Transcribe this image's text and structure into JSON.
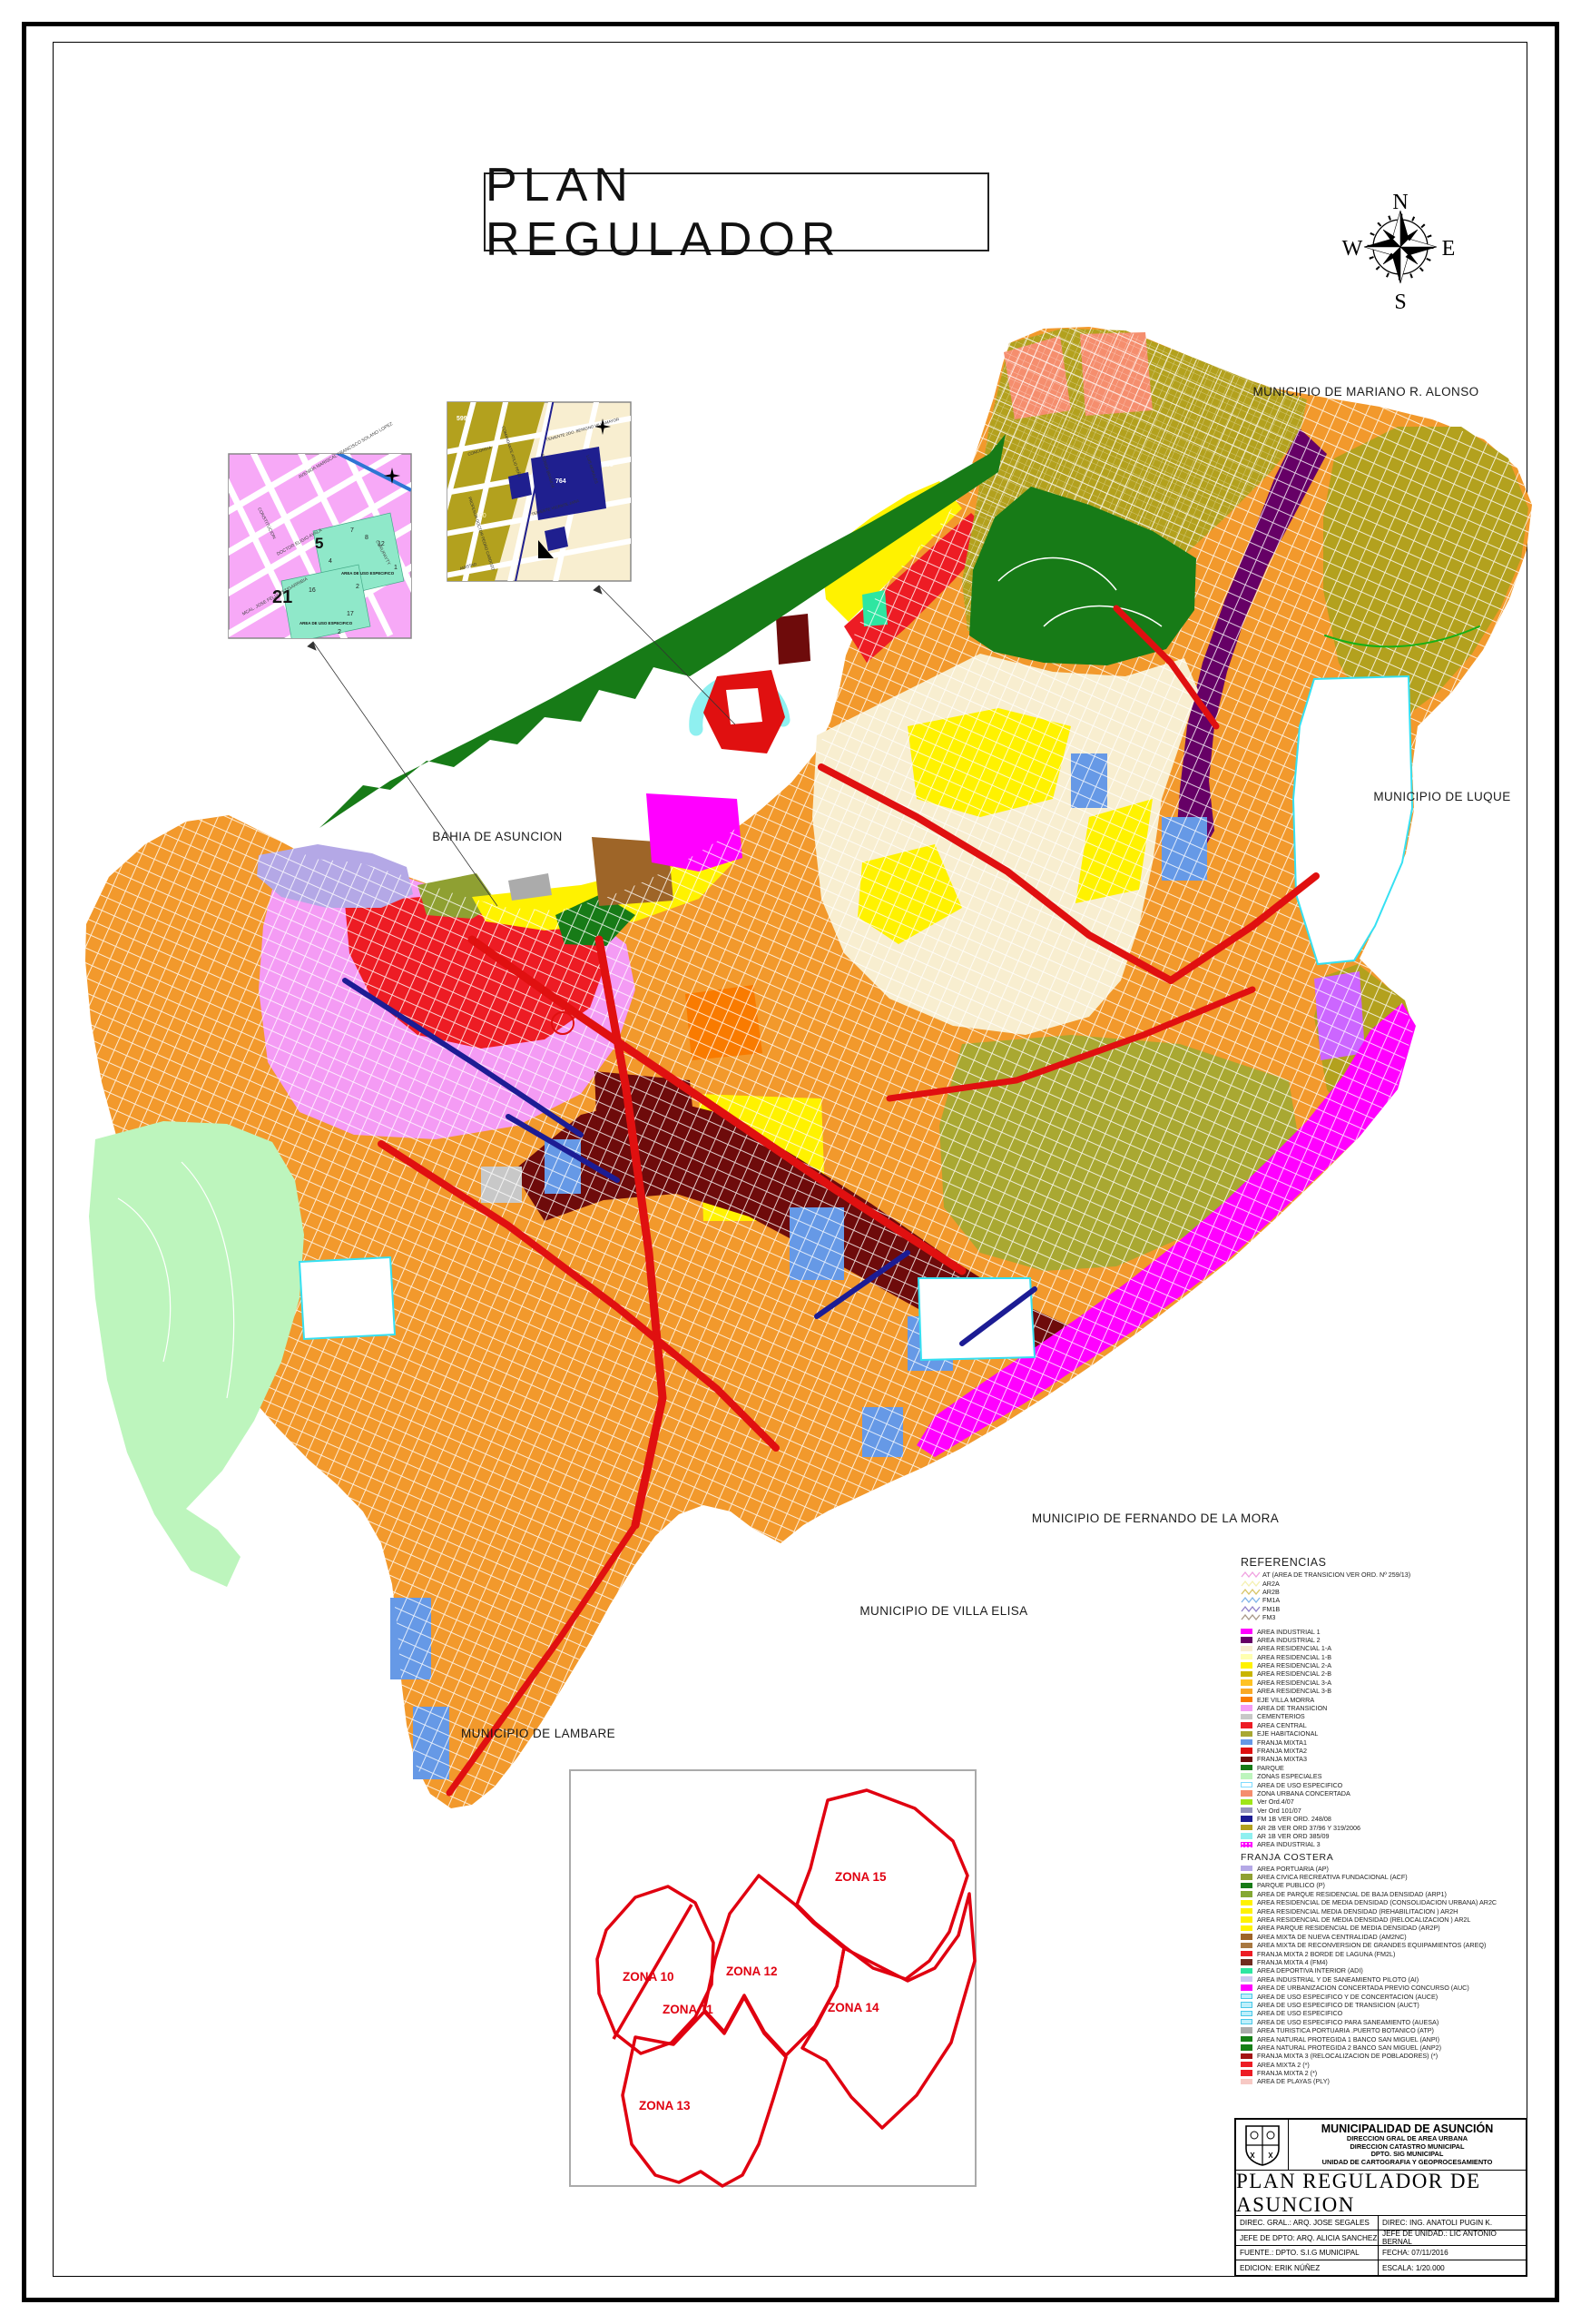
{
  "page": {
    "title": "PLAN REGULADOR"
  },
  "compass": {
    "n": "N",
    "e": "E",
    "s": "S",
    "w": "W"
  },
  "labels": {
    "mariano": "MUNICIPIO DE MARIANO R. ALONSO",
    "luque": "MUNICIPIO DE LUQUE",
    "fernando": "MUNICIPIO DE FERNANDO DE LA MORA",
    "villa_elisa": "MUNICIPIO DE VILLA ELISA",
    "lambare": "MUNICIPIO DE LAMBARE",
    "bahia": "BAHIA DE ASUNCION"
  },
  "zones": {
    "labels": [
      "ZONA 10",
      "ZONA 11",
      "ZONA 12",
      "ZONA 13",
      "ZONA 14",
      "ZONA 15"
    ]
  },
  "insets": {
    "a": {
      "numbers": [
        "5",
        "21",
        "7",
        "8",
        "12",
        "4",
        "1",
        "2",
        "16",
        "17"
      ],
      "area_label": "AREA DE USO ESPECIFICO",
      "streets": [
        "CONSTITUCION",
        "AVENIDA MARISCAL FRANCISCO SOLANO LOPEZ",
        "DOCTOR ELIGIO AYALA",
        "CURUPAYTY",
        "MCAL. JOSE FELIX ESTIGARRIBIA"
      ]
    },
    "b": {
      "numbers": [
        "599",
        "600",
        "764",
        "765"
      ],
      "streets": [
        "CONCORDIA",
        "AMISTAD",
        "TENIENTE VICENTE JARA",
        "TENIENTE 2DO. BENIGNO VILLAMAYOR",
        "COMANDANTE ATILIO PEÑA",
        "AVENIDA BRASILIA",
        "PROFESOR DOCTOR PEDRO CARDOZO",
        "LUIS MORALES"
      ]
    }
  },
  "legend": {
    "title": "REFERENCIAS",
    "line_items": [
      {
        "label": "AT (AREA DE TRANSICION VER ORD. Nº 259/13)",
        "color": "#F0A0E0"
      },
      {
        "label": "AR2A",
        "color": "#F5F0B0"
      },
      {
        "label": "AR2B",
        "color": "#D6C464"
      },
      {
        "label": "FM1A",
        "color": "#7FB3E8"
      },
      {
        "label": "FM1B",
        "color": "#8F7FC8"
      },
      {
        "label": "FM3",
        "color": "#A89888"
      }
    ],
    "items": [
      {
        "label": "AREA INDUSTRIAL 1",
        "color": "#FF00FF"
      },
      {
        "label": "AREA INDUSTRIAL 2",
        "color": "#660066"
      },
      {
        "label": "AREA RESIDENCIAL 1-A",
        "color": "#F8EED0"
      },
      {
        "label": "AREA RESIDENCIAL 1-B",
        "color": "#FFFFB0"
      },
      {
        "label": "AREA RESIDENCIAL 2-A",
        "color": "#FFF200"
      },
      {
        "label": "AREA RESIDENCIAL 2-B",
        "color": "#C9B500"
      },
      {
        "label": "AREA RESIDENCIAL 3-A",
        "color": "#FFC222"
      },
      {
        "label": "AREA RESIDENCIAL 3-B",
        "color": "#F9A825"
      },
      {
        "label": "EJE VILLA MORRA",
        "color": "#F97B00"
      },
      {
        "label": "AREA DE TRANSICION",
        "color": "#F49BF4"
      },
      {
        "label": "CEMENTERIOS",
        "color": "#C8C8C8"
      },
      {
        "label": "AREA CENTRAL",
        "color": "#ED1C24"
      },
      {
        "label": "EJE HABITACIONAL",
        "color": "#A9A832"
      },
      {
        "label": "FRANJA MIXTA1",
        "color": "#6699E6"
      },
      {
        "label": "FRANJA MIXTA2",
        "color": "#E01010"
      },
      {
        "label": "FRANJA MIXTA3",
        "color": "#6E0B0B"
      },
      {
        "label": "PARQUE",
        "color": "#177B17"
      },
      {
        "label": "ZONAS ESPECIALES",
        "color": "#BDF5BD"
      },
      {
        "label": "AREA DE USO ESPECIFICO",
        "color": "#FFFFFF",
        "border": "#7FDBFF"
      },
      {
        "label": "ZONA URBANA CONCERTADA",
        "color": "#F58E6E"
      },
      {
        "label": "Ver Ord.4/07",
        "color": "#A0E619"
      },
      {
        "label": "Ver Ord 101/07",
        "color": "#9494BC"
      },
      {
        "label": "FM 1B VER ORD. 248/08",
        "color": "#1C1C94"
      },
      {
        "label": "AR 2B VER ORD 37/96 Y 319/2006",
        "color": "#B3A11E"
      },
      {
        "label": "AR 1B VER ORD 385/09",
        "color": "#8FF0F0"
      },
      {
        "label": "AREA INDUSTRIAL 3",
        "color": "#FF00FF",
        "pattern": "dots"
      }
    ],
    "costera_title": "FRANJA COSTERA",
    "costera_items": [
      {
        "label": "AREA PORTUARIA (AP)",
        "color": "#B4A8E6"
      },
      {
        "label": "AREA CIVICA RECREATIVA FUNDACIONAL (ACF)",
        "color": "#8FA032"
      },
      {
        "label": "PARQUE PUBLICO (P)",
        "color": "#177B17"
      },
      {
        "label": "AREA  DE PARQUE RESIDENCIAL DE BAJA DENSIDAD  (ARP1)",
        "color": "#84A833"
      },
      {
        "label": "AREA RESIDENCIAL DE MEDIA DENSIDAD (CONSOLIDACION URBANA) AR2C",
        "color": "#FFF200"
      },
      {
        "label": "AREA RESIDENCIAL MEDIA DENSIDAD (REHABILITACION ) AR2H",
        "color": "#FFF200"
      },
      {
        "label": "AREA RESIDENCIAL DE MEDIA DENSIDAD (RELOCALIZACION ) AR2L",
        "color": "#FFF200"
      },
      {
        "label": "AREA  PARQUE RESIDENCIAL DE MEDIA DENSIDAD (AR2P)",
        "color": "#FFF200"
      },
      {
        "label": "AREA MIXTA DE NUEVA CENTRALIDAD (AM2NC)",
        "color": "#9E6528"
      },
      {
        "label": "AREA MIXTA DE RECONVERSION DE GRANDES EQUIPAMIENTOS (AREQ)",
        "color": "#A87840"
      },
      {
        "label": "FRANJA MIXTA 2  BORDE DE LAGUNA (FM2L)",
        "color": "#ED1C24"
      },
      {
        "label": "FRANJA MIXTA 4  (FM4)",
        "color": "#702C20"
      },
      {
        "label": "AREA DEPORTIVA INTERIOR (ADI)",
        "color": "#2EE6A1"
      },
      {
        "label": "AREA INDUSTRIAL Y DE SANEAMIENTO PILOTO (AI)",
        "color": "#C9C9F0"
      },
      {
        "label": "AREA DE URBANIZACION CONCERTADA  PREVIO CONCURSO (AUC)",
        "color": "#FF00FF"
      },
      {
        "label": "AREA DE USO ESPECIFICO  Y DE CONCERTACION (AUCE)",
        "color": "#BEEFFB",
        "border": "#49C8E8"
      },
      {
        "label": "AREA DE USO ESPECIFICO DE TRANSICION (AUCT)",
        "color": "#BEEFFB",
        "border": "#49C8E8"
      },
      {
        "label": "AREA DE USO ESPECIFICO",
        "color": "#BEEFFB",
        "border": "#49C8E8"
      },
      {
        "label": "AREA DE USO ESPECIFICO PARA SANEAMIENTO (AUESA)",
        "color": "#BEEFFB",
        "border": "#49C8E8"
      },
      {
        "label": "AREA TURISTICA PORTUARIA .PUERTO BOTANICO (ATP)",
        "color": "#ABABAB"
      },
      {
        "label": "AREA NATURAL PROTEGIDA  1 BANCO SAN MIGUEL (ANPI)",
        "color": "#178017"
      },
      {
        "label": "AREA NATURAL PROTEGIDA 2 BANCO SAN MIGUEL (ANP2)",
        "color": "#178017"
      },
      {
        "label": "FRANJA MIXTA 3 (RELOCALIZACION DE POBLADORES) (*)",
        "color": "#A31515"
      },
      {
        "label": "AREA MIXTA 2 (*)",
        "color": "#ED1C24"
      },
      {
        "label": "FRANJA MIXTA 2 (*)",
        "color": "#ED1C24"
      },
      {
        "label": "AREA DE PLAYAS (PLY)",
        "color": "#F7C9C4"
      }
    ]
  },
  "title_block": {
    "org": "MUNICIPALIDAD DE ASUNCIÓN",
    "dept_lines": [
      "DIRECCION GRAL DE AREA URBANA",
      "DIRECCION CATASTRO MUNICIPAL",
      "DPTO. SIG MUNICIPAL",
      "UNIDAD DE CARTOGRAFIA Y GEOPROCESAMIENTO"
    ],
    "map_title": "PLAN REGULADOR DE ASUNCION",
    "rows": [
      [
        "DIREC. GRAL.: ARQ. JOSE SEGALES",
        "DIREC: ING. ANATOLI PUGIN K."
      ],
      [
        "JEFE DE DPTO: ARQ. ALICIA SANCHEZ",
        "JEFE DE UNIDAD.: LIC ANTONIO BERNAL"
      ],
      [
        "FUENTE.: DPTO. S.I.G MUNICIPAL",
        "FECHA: 07/11/2016"
      ],
      [
        "EDICION: ERIK NÚÑEZ",
        "ESCALA: 1/20.000"
      ]
    ]
  }
}
